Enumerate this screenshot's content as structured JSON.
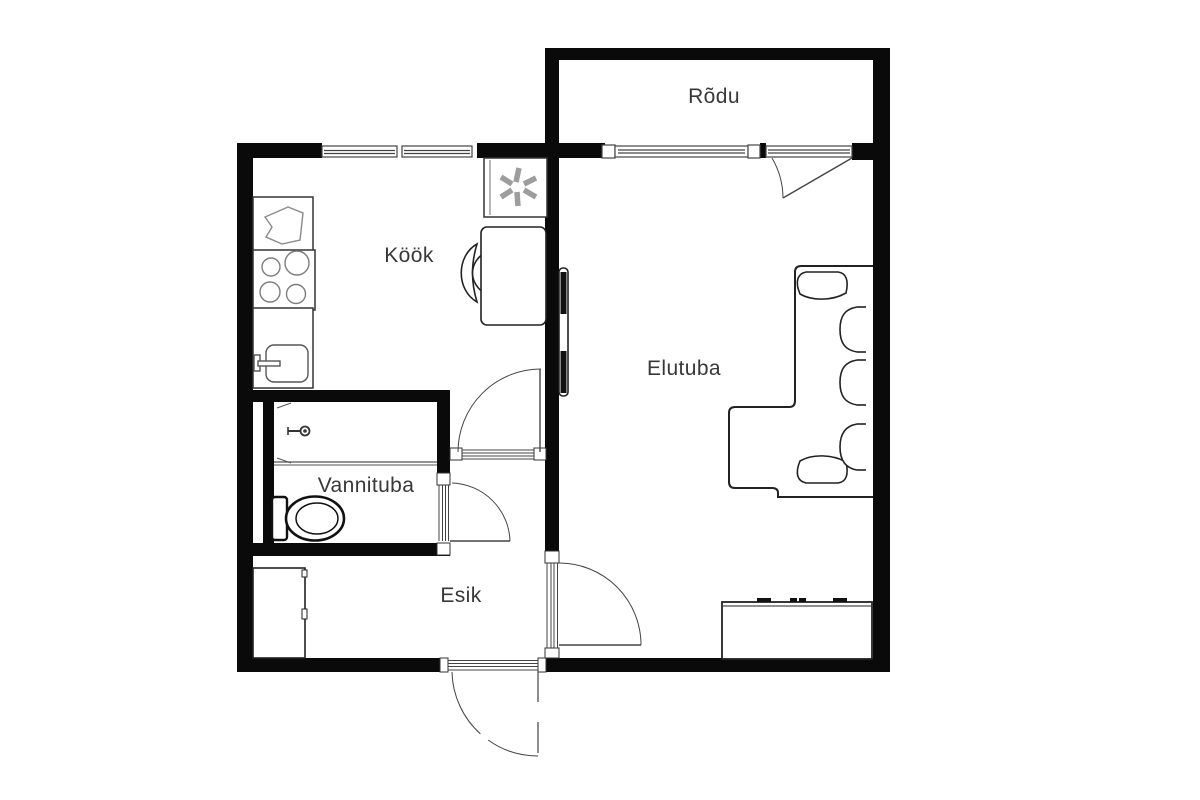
{
  "floor_plan": {
    "rooms": [
      {
        "id": "rodu",
        "label": "Rõdu"
      },
      {
        "id": "kook",
        "label": "Köök"
      },
      {
        "id": "elutuba",
        "label": "Elutuba"
      },
      {
        "id": "vannituba",
        "label": "Vannituba"
      },
      {
        "id": "esik",
        "label": "Esik"
      }
    ],
    "fixtures": [
      "fridge-freezer-icon",
      "kitchen-counter",
      "stove-burners-icon",
      "kitchen-sink-icon",
      "dining-table",
      "chair",
      "tv",
      "corner-sofa",
      "sideboard",
      "shower-head-icon",
      "toilet-icon",
      "wardrobe",
      "window",
      "door-swing",
      "entrance-door"
    ],
    "colors": {
      "wall": "#0a0a0a",
      "background": "#ffffff",
      "furniture_stroke": "#222222",
      "light_stroke": "#888888",
      "fridge_star": "#9d9d9d",
      "label_text": "#383838"
    }
  }
}
